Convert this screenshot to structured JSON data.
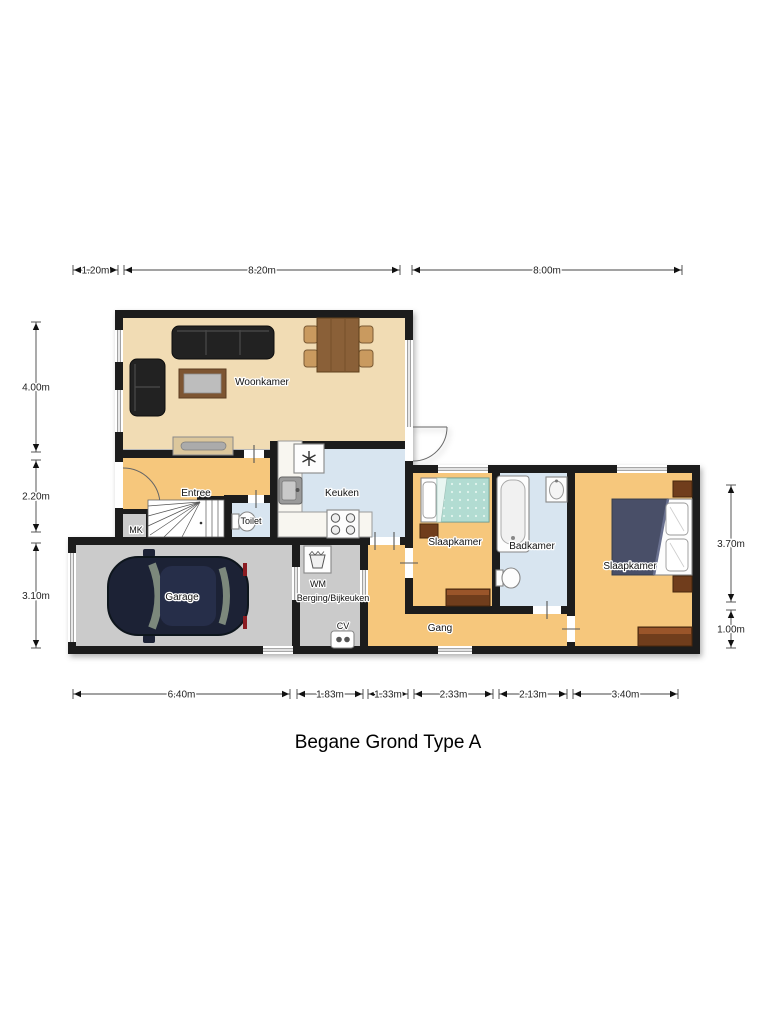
{
  "title": "Begane Grond Type A",
  "rooms": {
    "woonkamer": "Woonkamer",
    "entree": "Entree",
    "toilet": "Toilet",
    "mk": "MK",
    "keuken": "Keuken",
    "garage": "Garage",
    "wm": "WM",
    "berging": "Berging/Bijkeuken",
    "cv": "CV",
    "slaapkamer1": "Slaapkamer",
    "badkamer": "Badkamer",
    "slaapkamer2": "Slaapkamer",
    "gang": "Gang"
  },
  "dimensions": {
    "top": [
      "1.20m",
      "8.20m",
      "8.00m"
    ],
    "left": [
      "4.00m",
      "2.20m",
      "3.10m"
    ],
    "right": [
      "3.70m",
      "1.00m"
    ],
    "bottom": [
      "6.40m",
      "1.83m",
      "1.33m",
      "2.33m",
      "2.13m",
      "3.40m"
    ]
  },
  "colors": {
    "wall": "#1a1a1a",
    "floor_living": "#f1dcb4",
    "floor_hall": "#f6c77c",
    "floor_wet": "#d8e5f0",
    "floor_garage": "#cbcbcb"
  }
}
